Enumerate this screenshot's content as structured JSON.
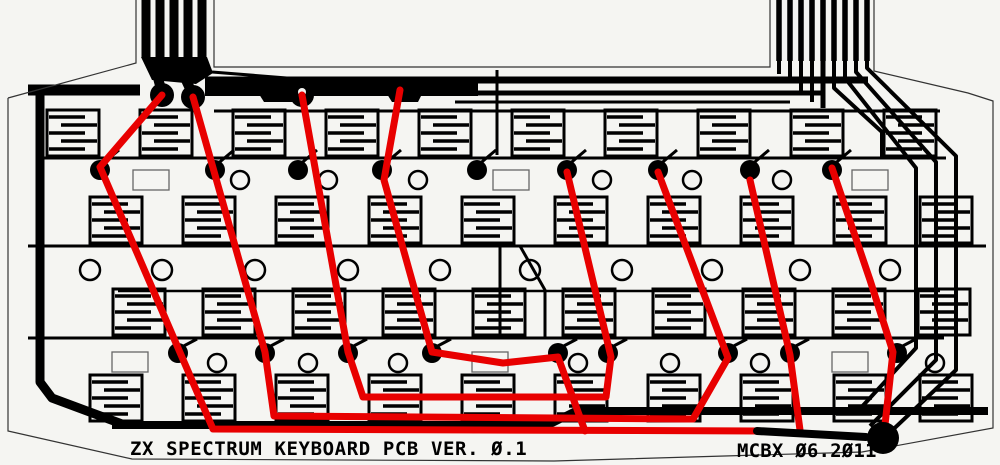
{
  "labels": {
    "bottom_left": "ZX SPECTRUM KEYBOARD PCB VER. Ø.1",
    "bottom_right": "MCBX Ø6.2Ø11"
  },
  "colors": {
    "background": "#f5f5f2",
    "trace_black": "#000000",
    "overlay_red": "#e80000",
    "outline_gray": "#333333",
    "component_rect_gray": "#666666"
  },
  "board": {
    "outline_path": "M 8,98 L 136,63 L 136,0 M 214,0 L 214,67 L 770,67 L 770,0 M 874,0 L 874,71 L 968,93 L 993,101 L 993,428 L 862,452 L 554,461 L 132,459 L 8,431 L 8,98",
    "connectors": {
      "left": {
        "bar_xs": [
          146,
          160,
          174,
          188,
          202
        ],
        "bar_width": 9,
        "y_top": -2,
        "y_bottom": 57
      },
      "right": {
        "bar_xs": [
          779,
          790,
          801,
          812,
          823,
          834,
          845,
          856,
          867
        ],
        "bar_width": 5.5,
        "y_top": -2,
        "y_bottom": 61
      }
    },
    "traces": [
      {
        "d": "M 28,90 L 140,90",
        "w": 11
      },
      {
        "d": "M 40,88 L 40,382 L 52,398 L 122,424",
        "w": 9
      },
      {
        "d": "M 112,425 L 548,425 L 576,411 L 988,411",
        "w": 8
      },
      {
        "d": "M 40,158 L 946,158",
        "w": 3
      },
      {
        "d": "M 28,246 L 986,246",
        "w": 3
      },
      {
        "d": "M 28,338 L 944,338",
        "w": 3
      },
      {
        "d": "M 118,291 L 940,291",
        "w": 2.5
      },
      {
        "d": "M 214,111 L 940,111",
        "w": 3
      },
      {
        "d": "M 205,80 L 868,80",
        "w": 7
      },
      {
        "d": "M 420,93 L 823,93",
        "w": 5
      },
      {
        "d": "M 455,102 L 790,102",
        "w": 3
      },
      {
        "d": "M 205,88 L 478,88",
        "w": 16
      },
      {
        "d": "M 823,60 L 823,108",
        "w": 5
      },
      {
        "d": "M 834,60 L 834,88 L 882,132 L 882,158",
        "w": 4
      },
      {
        "d": "M 845,60 L 845,78 L 916,168 L 916,348 L 858,411",
        "w": 4
      },
      {
        "d": "M 856,60 L 856,72 L 936,162 L 936,360 L 870,426",
        "w": 4
      },
      {
        "d": "M 867,60 L 867,68 L 956,156 L 956,370 L 882,440",
        "w": 4
      },
      {
        "d": "M 779,60 L 779,74",
        "w": 4
      },
      {
        "d": "M 790,60 L 790,82",
        "w": 4
      },
      {
        "d": "M 801,60 L 801,93",
        "w": 4
      },
      {
        "d": "M 812,60 L 812,102",
        "w": 4
      },
      {
        "d": "M 497,70 L 497,155",
        "w": 3
      },
      {
        "d": "M 500,246 L 500,338",
        "w": 3
      },
      {
        "d": "M 520,246 L 545,290 L 545,338",
        "w": 3
      },
      {
        "d": "M 158,78 L 162,93",
        "w": 10
      },
      {
        "d": "M 186,80 L 193,95",
        "w": 10
      },
      {
        "d": "M 212,72 L 362,84",
        "w": 3
      }
    ],
    "fill_polygons": [
      "141,57 207,57 213,73 196,84 152,80",
      "252,83 310,83 304,102 264,102",
      "377,78 430,78 418,102 392,102"
    ],
    "connector_pads": [
      [
        162,
        95
      ],
      [
        193,
        97
      ],
      [
        302,
        95
      ],
      [
        400,
        90
      ]
    ],
    "connector_pad_radius": 12,
    "comb": {
      "w": 52,
      "h": 46,
      "fingers": 5,
      "stroke": 3
    },
    "comb_bands": [
      {
        "y": 110,
        "xs": [
          47,
          140,
          233,
          326,
          419,
          512,
          605,
          698,
          791,
          884
        ]
      },
      {
        "y": 197,
        "xs": [
          90,
          183,
          276,
          369,
          462,
          555,
          648,
          741,
          834,
          920
        ]
      },
      {
        "y": 289,
        "xs": [
          113,
          203,
          293,
          383,
          473,
          563,
          653,
          743,
          833,
          918
        ]
      },
      {
        "y": 375,
        "xs": [
          90,
          183,
          276,
          369,
          462,
          555,
          648,
          741,
          834,
          920
        ]
      }
    ],
    "via_dot_radius": 10,
    "via_dots": {
      "row1": {
        "y": 170,
        "xs": [
          100,
          215,
          298,
          382,
          477,
          567,
          658,
          750,
          832
        ]
      },
      "row4": {
        "y": 353,
        "xs": [
          178,
          265,
          348,
          432,
          558,
          608,
          728,
          790,
          897
        ]
      }
    },
    "holes": [
      {
        "y": 180,
        "r": 9,
        "xs": [
          240,
          328,
          418,
          602,
          692,
          782
        ]
      },
      {
        "y": 270,
        "r": 10,
        "xs": [
          90,
          162,
          255,
          348,
          440,
          530,
          622,
          712,
          800,
          890
        ]
      },
      {
        "y": 363,
        "r": 9,
        "xs": [
          217,
          308,
          398,
          578,
          670,
          760,
          935
        ]
      }
    ],
    "component_rects": [
      [
        133,
        170,
        36,
        20
      ],
      [
        493,
        170,
        36,
        20
      ],
      [
        852,
        170,
        36,
        20
      ],
      [
        112,
        352,
        36,
        20
      ],
      [
        472,
        352,
        36,
        20
      ],
      [
        832,
        352,
        36,
        20
      ]
    ]
  },
  "red_overlay": {
    "stroke_width": 7,
    "nets": [
      {
        "name": "net-a",
        "points": [
          [
            162,
            95
          ],
          [
            100,
            167
          ],
          [
            213,
            429
          ],
          [
            760,
            431
          ]
        ]
      },
      {
        "name": "net-a-right-branch",
        "points": [
          [
            750,
            180
          ],
          [
            790,
            355
          ],
          [
            800,
            430
          ]
        ]
      },
      {
        "name": "net-b",
        "points": [
          [
            193,
            97
          ],
          [
            265,
            352
          ],
          [
            274,
            416
          ],
          [
            693,
            419
          ],
          [
            728,
            358
          ],
          [
            658,
            172
          ]
        ]
      },
      {
        "name": "net-c",
        "points": [
          [
            302,
            95
          ],
          [
            348,
            352
          ],
          [
            363,
            397
          ],
          [
            606,
            397
          ],
          [
            611,
            357
          ],
          [
            567,
            172
          ]
        ]
      },
      {
        "name": "net-d",
        "points": [
          [
            400,
            90
          ],
          [
            384,
            180
          ],
          [
            432,
            352
          ],
          [
            503,
            363
          ],
          [
            558,
            357
          ],
          [
            585,
            431
          ]
        ]
      },
      {
        "name": "net-e",
        "points": [
          [
            832,
            168
          ],
          [
            870,
            280
          ],
          [
            893,
            352
          ],
          [
            884,
            434
          ]
        ]
      }
    ]
  },
  "bottom_jumper": {
    "d": "M 757,431 L 866,437",
    "w": 8
  },
  "solder_pad": {
    "x": 883,
    "y": 438,
    "r": 16
  }
}
